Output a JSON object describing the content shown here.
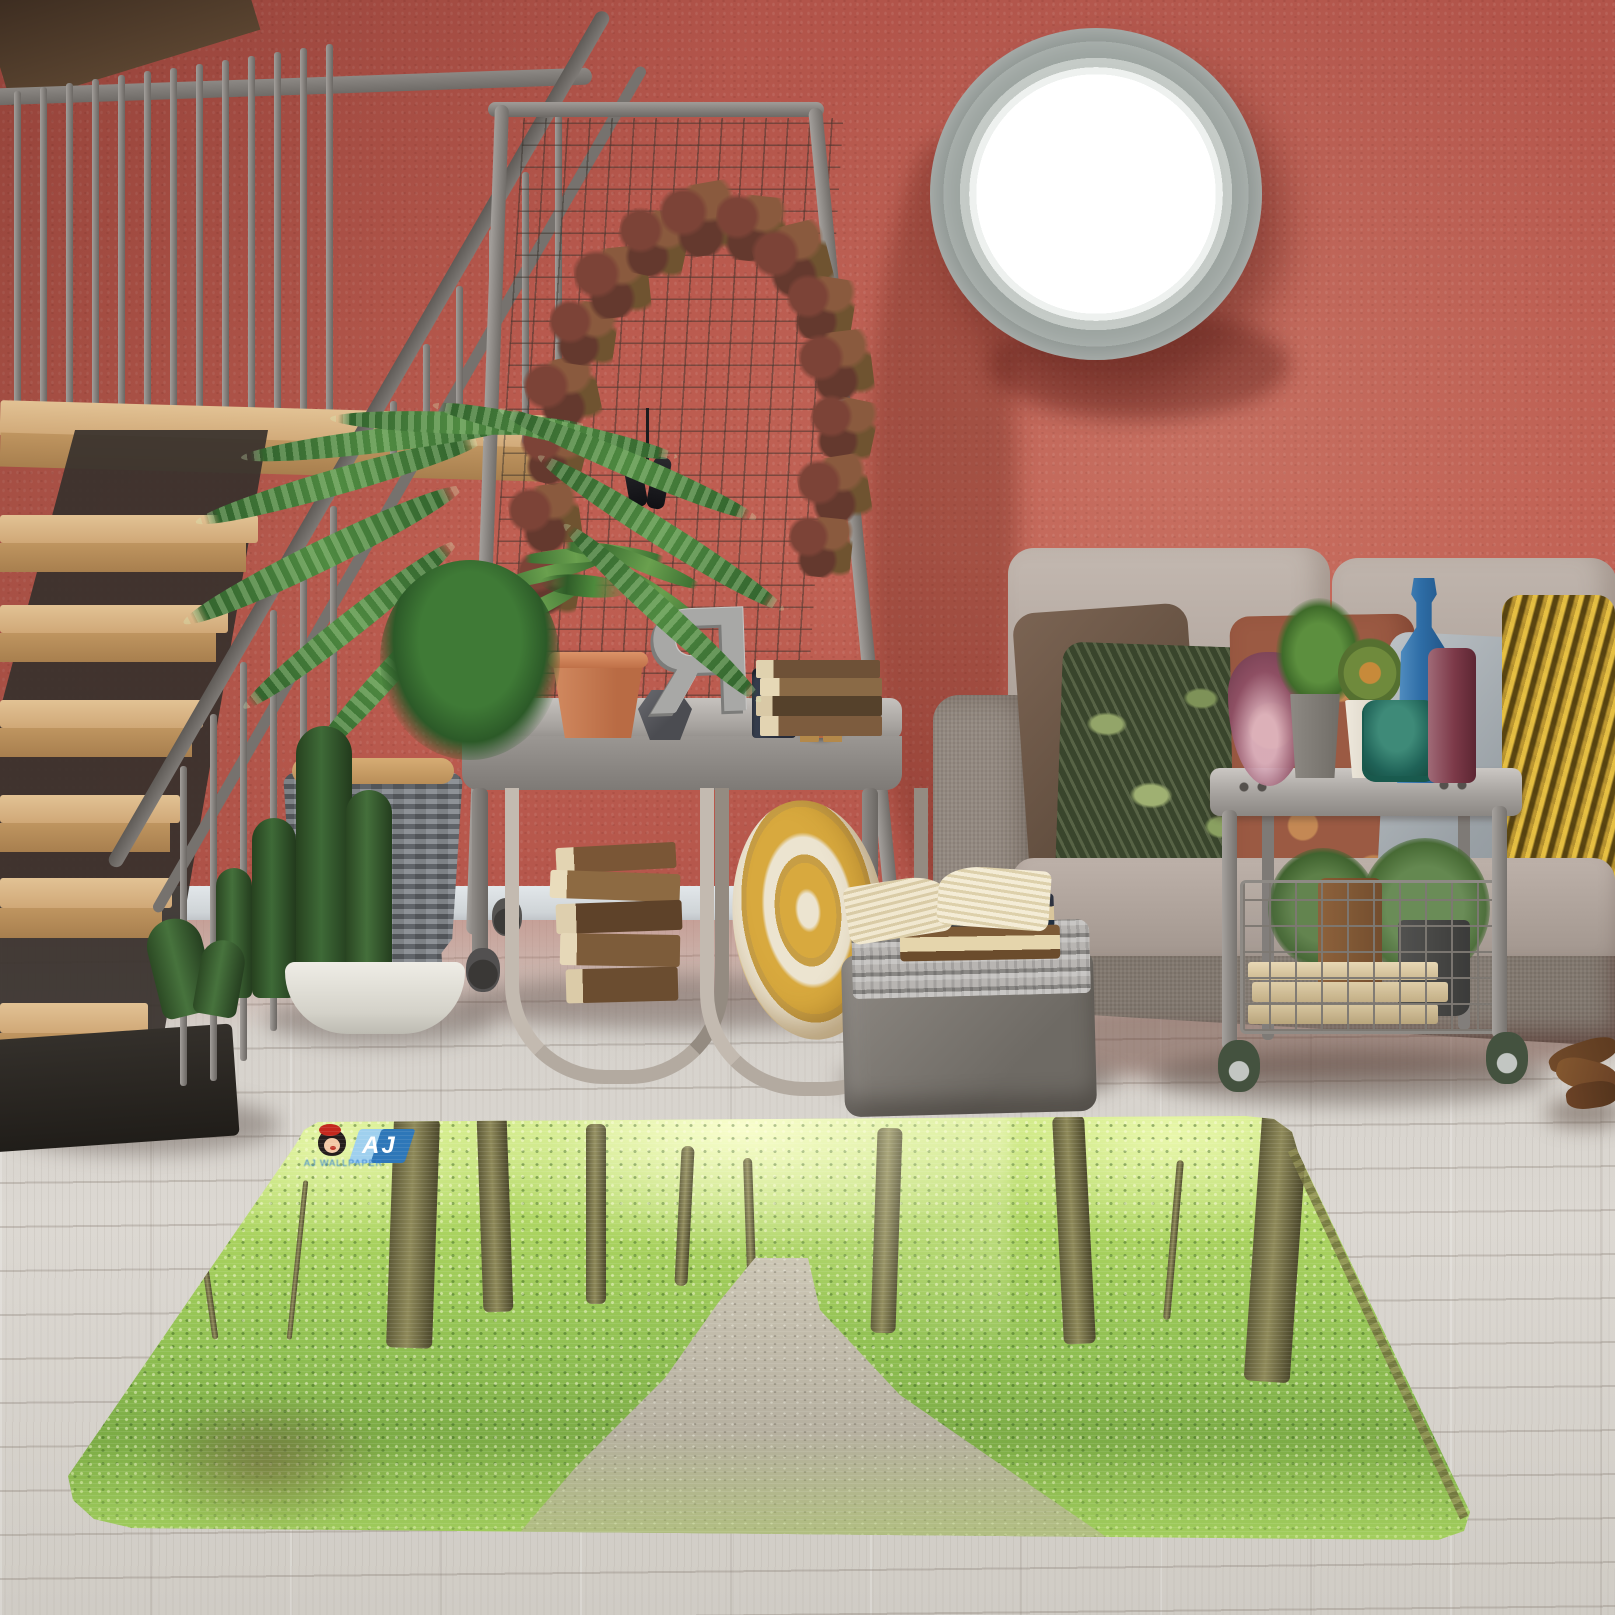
{
  "scene": {
    "description": "Loft living room with terracotta stucco wall, whitewashed wood floor and a 3D forest-path print rug",
    "wall_color": "#b85a4d",
    "baseboard_color": "#d8dde0",
    "floor_color": "#d3cec7"
  },
  "rug": {
    "type": "rectangular photo-print rug, forest path scene, rounded corners",
    "colors": {
      "foliage_bright": "#cde97e",
      "foliage_mid": "#8fbf52",
      "foliage_dark": "#4d7a2c",
      "path": "#c3bdae",
      "binding": "#84824c"
    },
    "logo": {
      "emblem": "AJ",
      "tagline": "AJ WALLPAPER",
      "emblem_color": "#2e77b8",
      "girl_icon": "cartoon-girl-red-beret"
    }
  },
  "shelf": {
    "letter": "R",
    "clock_time": "10:10"
  },
  "palette": {
    "metal": "#8e8a86",
    "stair_wood": "#d7b286",
    "sofa_fabric": "#8d8279",
    "back_cushion": "#b6aaa2",
    "pillow_brown": "#6b5747",
    "pillow_green": "#39452c",
    "pillow_terracotta": "#9b5a43",
    "pillow_gray": "#a9b0b5",
    "pillow_gold": "#8a6d20",
    "terracotta_pot": "#c57b54",
    "blanket_roll": "#d8a93e",
    "clock_face": "#2c3a55",
    "clock_rim": "#b4673f",
    "glass_blue": "#2e6da6",
    "glass_plum": "#8e4f63",
    "glass_teal": "#1f6257",
    "wheel_green": "#5b6e56"
  },
  "objects": [
    "staircase-with-metal-railing",
    "mesh-garment-rack",
    "autumn-leaf-garland",
    "binoculars",
    "metal-console-shelf",
    "fern-in-terracotta-pot",
    "geometric-vase",
    "mirrored-letter-R",
    "candle-jar",
    "alarm-clock",
    "stacked-books",
    "fabric-sling-pockets",
    "rolled-yellow-blanket",
    "porthole-mirror",
    "areca-palm-in-wicker-basket",
    "cactus-in-white-bowl",
    "gray-sofa",
    "throw-pillows",
    "metal-side-cart",
    "glass-vases",
    "wire-basket-with-plants-and-books",
    "gray-pouf",
    "knit-throw",
    "open-book",
    "driftwood",
    "forest-path-rug",
    "brand-logo"
  ]
}
